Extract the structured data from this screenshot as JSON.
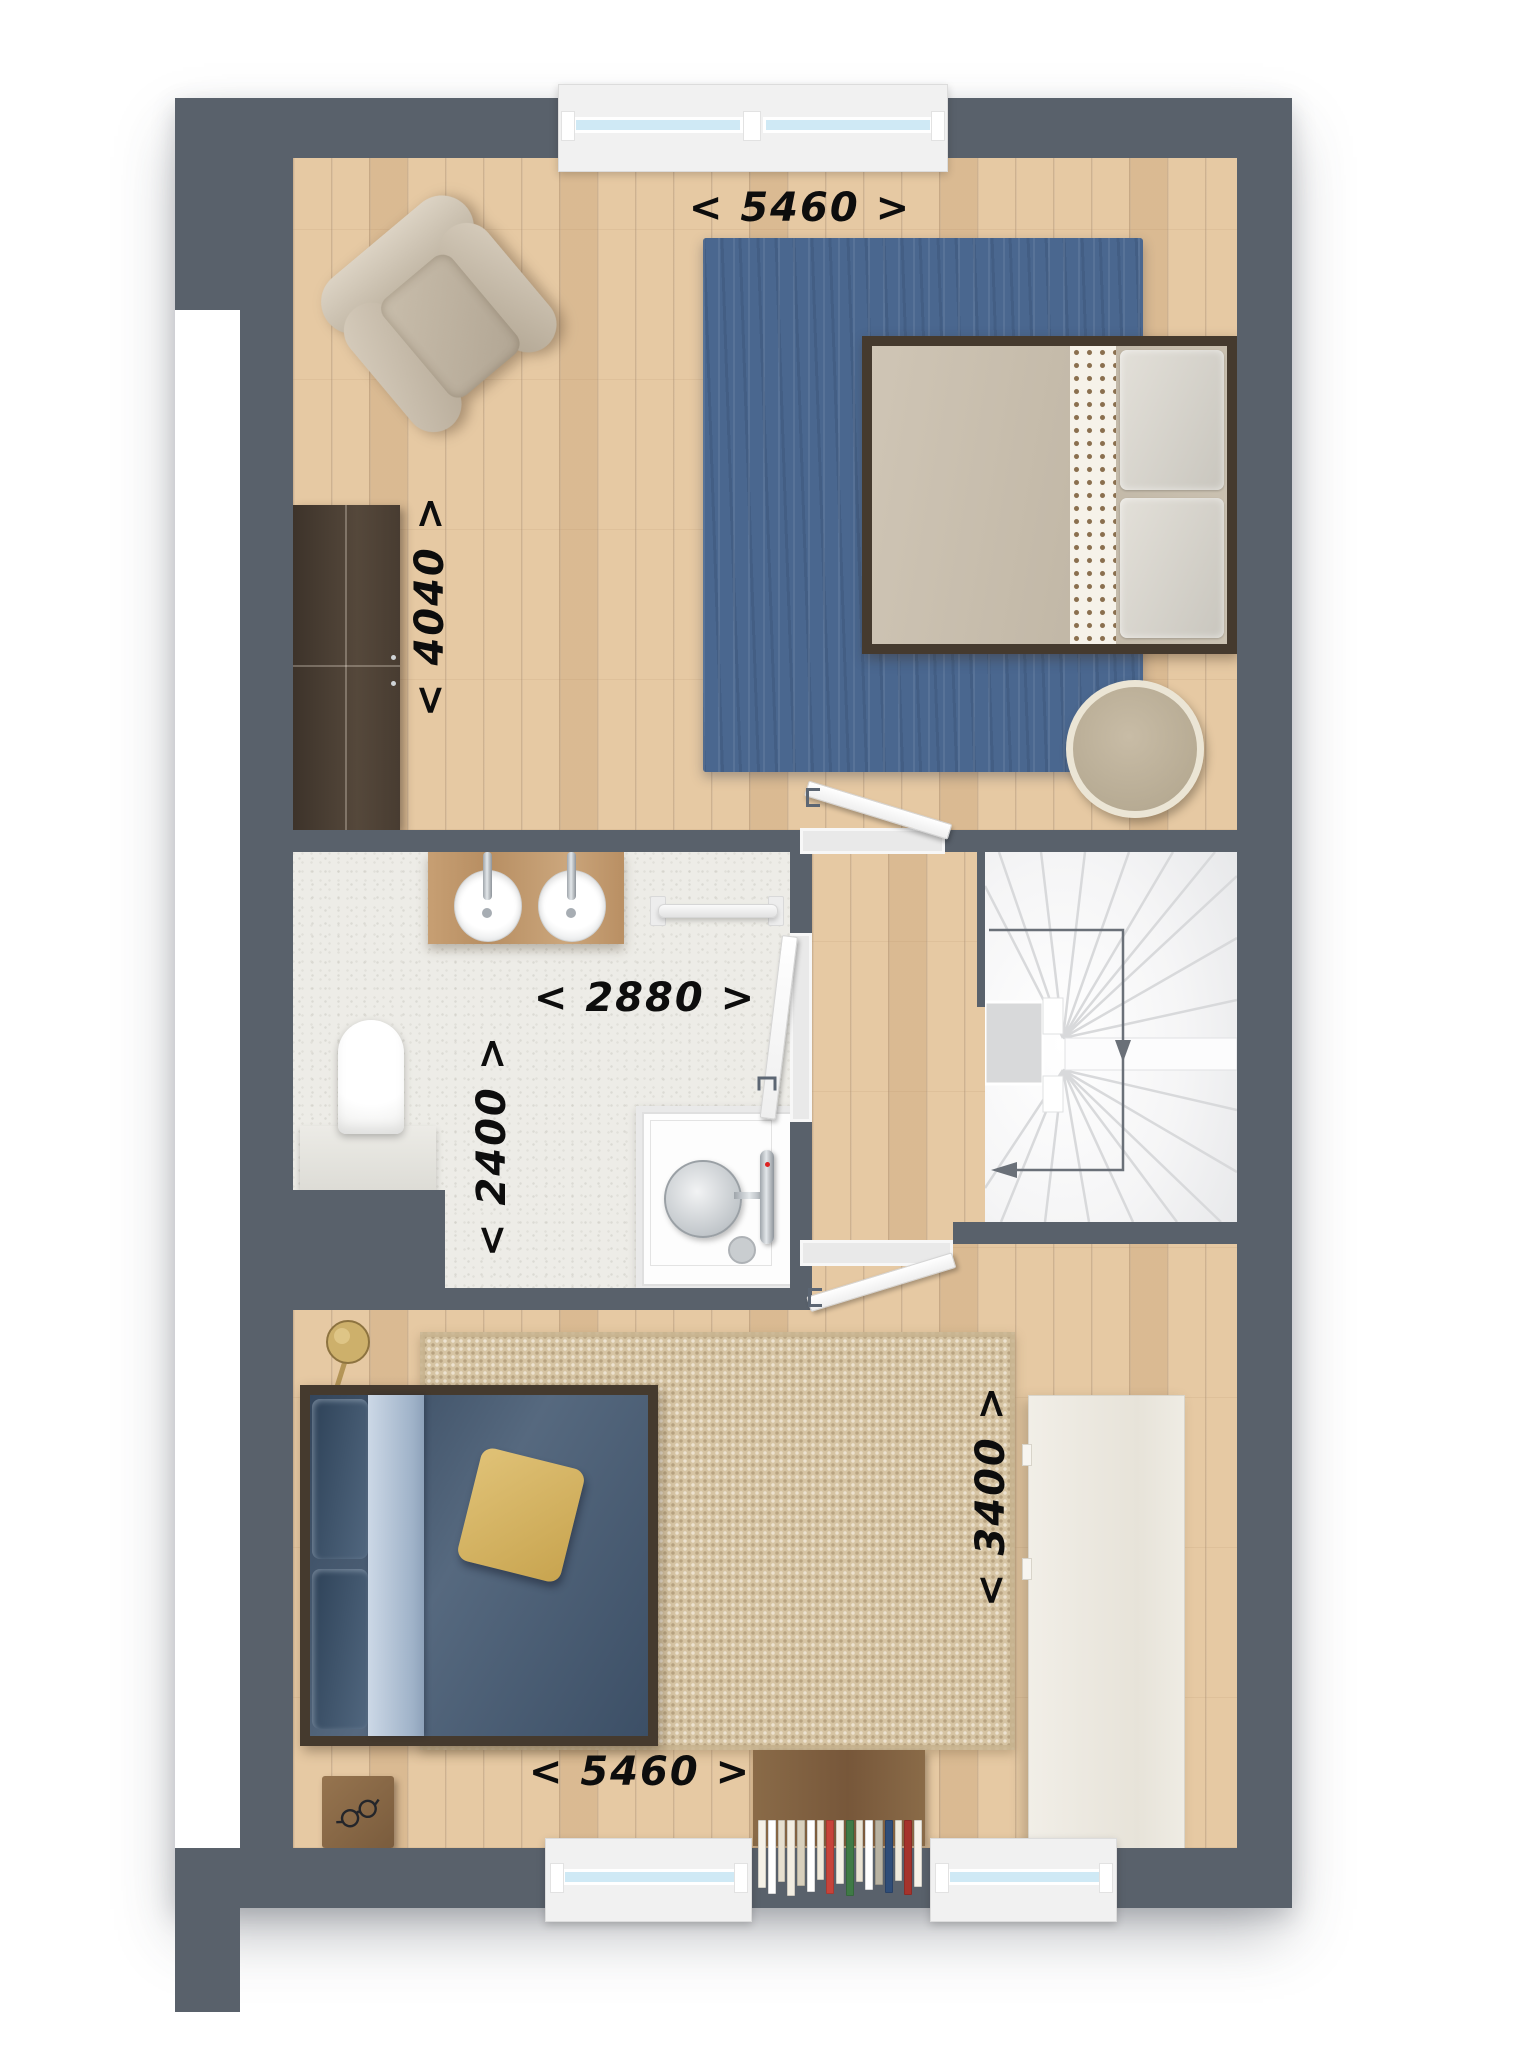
{
  "floorplan": {
    "title": "first-floor plan with two bedrooms, bathroom and winder staircase",
    "palette": {
      "wall": "#59616b",
      "wood": "#e6c9a3",
      "bath_floor": "#edece7",
      "stairs_floor": "#f4f4f5",
      "rug_blue": "#4a678f",
      "rug_beige": "#d6c4a3",
      "bed_frame": "#453a2e",
      "bed1_duvet": "#cac0b0",
      "bed2_duvet": "#42566d",
      "bed2_sheet": "#b6c4d6",
      "pillow_accent": "#d9b968",
      "window_glass": "#cfe9f5",
      "dim_text": "#0d0d0d"
    },
    "dimensions": {
      "bedroom_top_width": "< 5460 >",
      "bedroom_top_depth": "< 4040 >",
      "bathroom_width": "< 2880 >",
      "bathroom_depth": "< 2400 >",
      "bedroom_bottom_width": "< 5460 >",
      "bedroom_bottom_depth": "< 3400 >"
    },
    "rooms": {
      "bedroom_top": {
        "furniture": [
          "armchair",
          "wardrobe",
          "area-rug-blue",
          "double-bed",
          "round-pouf"
        ]
      },
      "bathroom": {
        "fixtures": [
          "vanity-two-sinks",
          "towel-rail",
          "wall-hung-toilet",
          "walk-in-shower"
        ]
      },
      "hall": {
        "doors": [
          "door-to-top-bedroom",
          "door-to-bathroom",
          "door-to-bottom-bedroom"
        ]
      },
      "stairs": {
        "type": "winder",
        "arrow": "down-then-left"
      },
      "bedroom_bottom": {
        "furniture": [
          "floor-lamp",
          "double-bed",
          "area-rug-beige",
          "nightstand-with-glasses",
          "dresser",
          "bookcase"
        ]
      }
    },
    "windows": {
      "top_wall": 1,
      "bottom_wall": 2
    },
    "bookcase": {
      "books": [
        {
          "c": "#f5f1e7",
          "h": 66
        },
        {
          "c": "#ffffff",
          "h": 72
        },
        {
          "c": "#e6dfcf",
          "h": 60
        },
        {
          "c": "#f2ede1",
          "h": 74
        },
        {
          "c": "#d8d0bd",
          "h": 64
        },
        {
          "c": "#ffffff",
          "h": 70
        },
        {
          "c": "#efe9da",
          "h": 58
        },
        {
          "c": "#c7433a",
          "h": 72
        },
        {
          "c": "#f4f0e6",
          "h": 62
        },
        {
          "c": "#3f7a46",
          "h": 74
        },
        {
          "c": "#e9e3d3",
          "h": 60
        },
        {
          "c": "#ffffff",
          "h": 68
        },
        {
          "c": "#b9b3a2",
          "h": 63
        },
        {
          "c": "#2f4d78",
          "h": 71
        },
        {
          "c": "#efeadc",
          "h": 59
        },
        {
          "c": "#a5332c",
          "h": 73
        },
        {
          "c": "#f6f2e9",
          "h": 65
        }
      ]
    }
  }
}
